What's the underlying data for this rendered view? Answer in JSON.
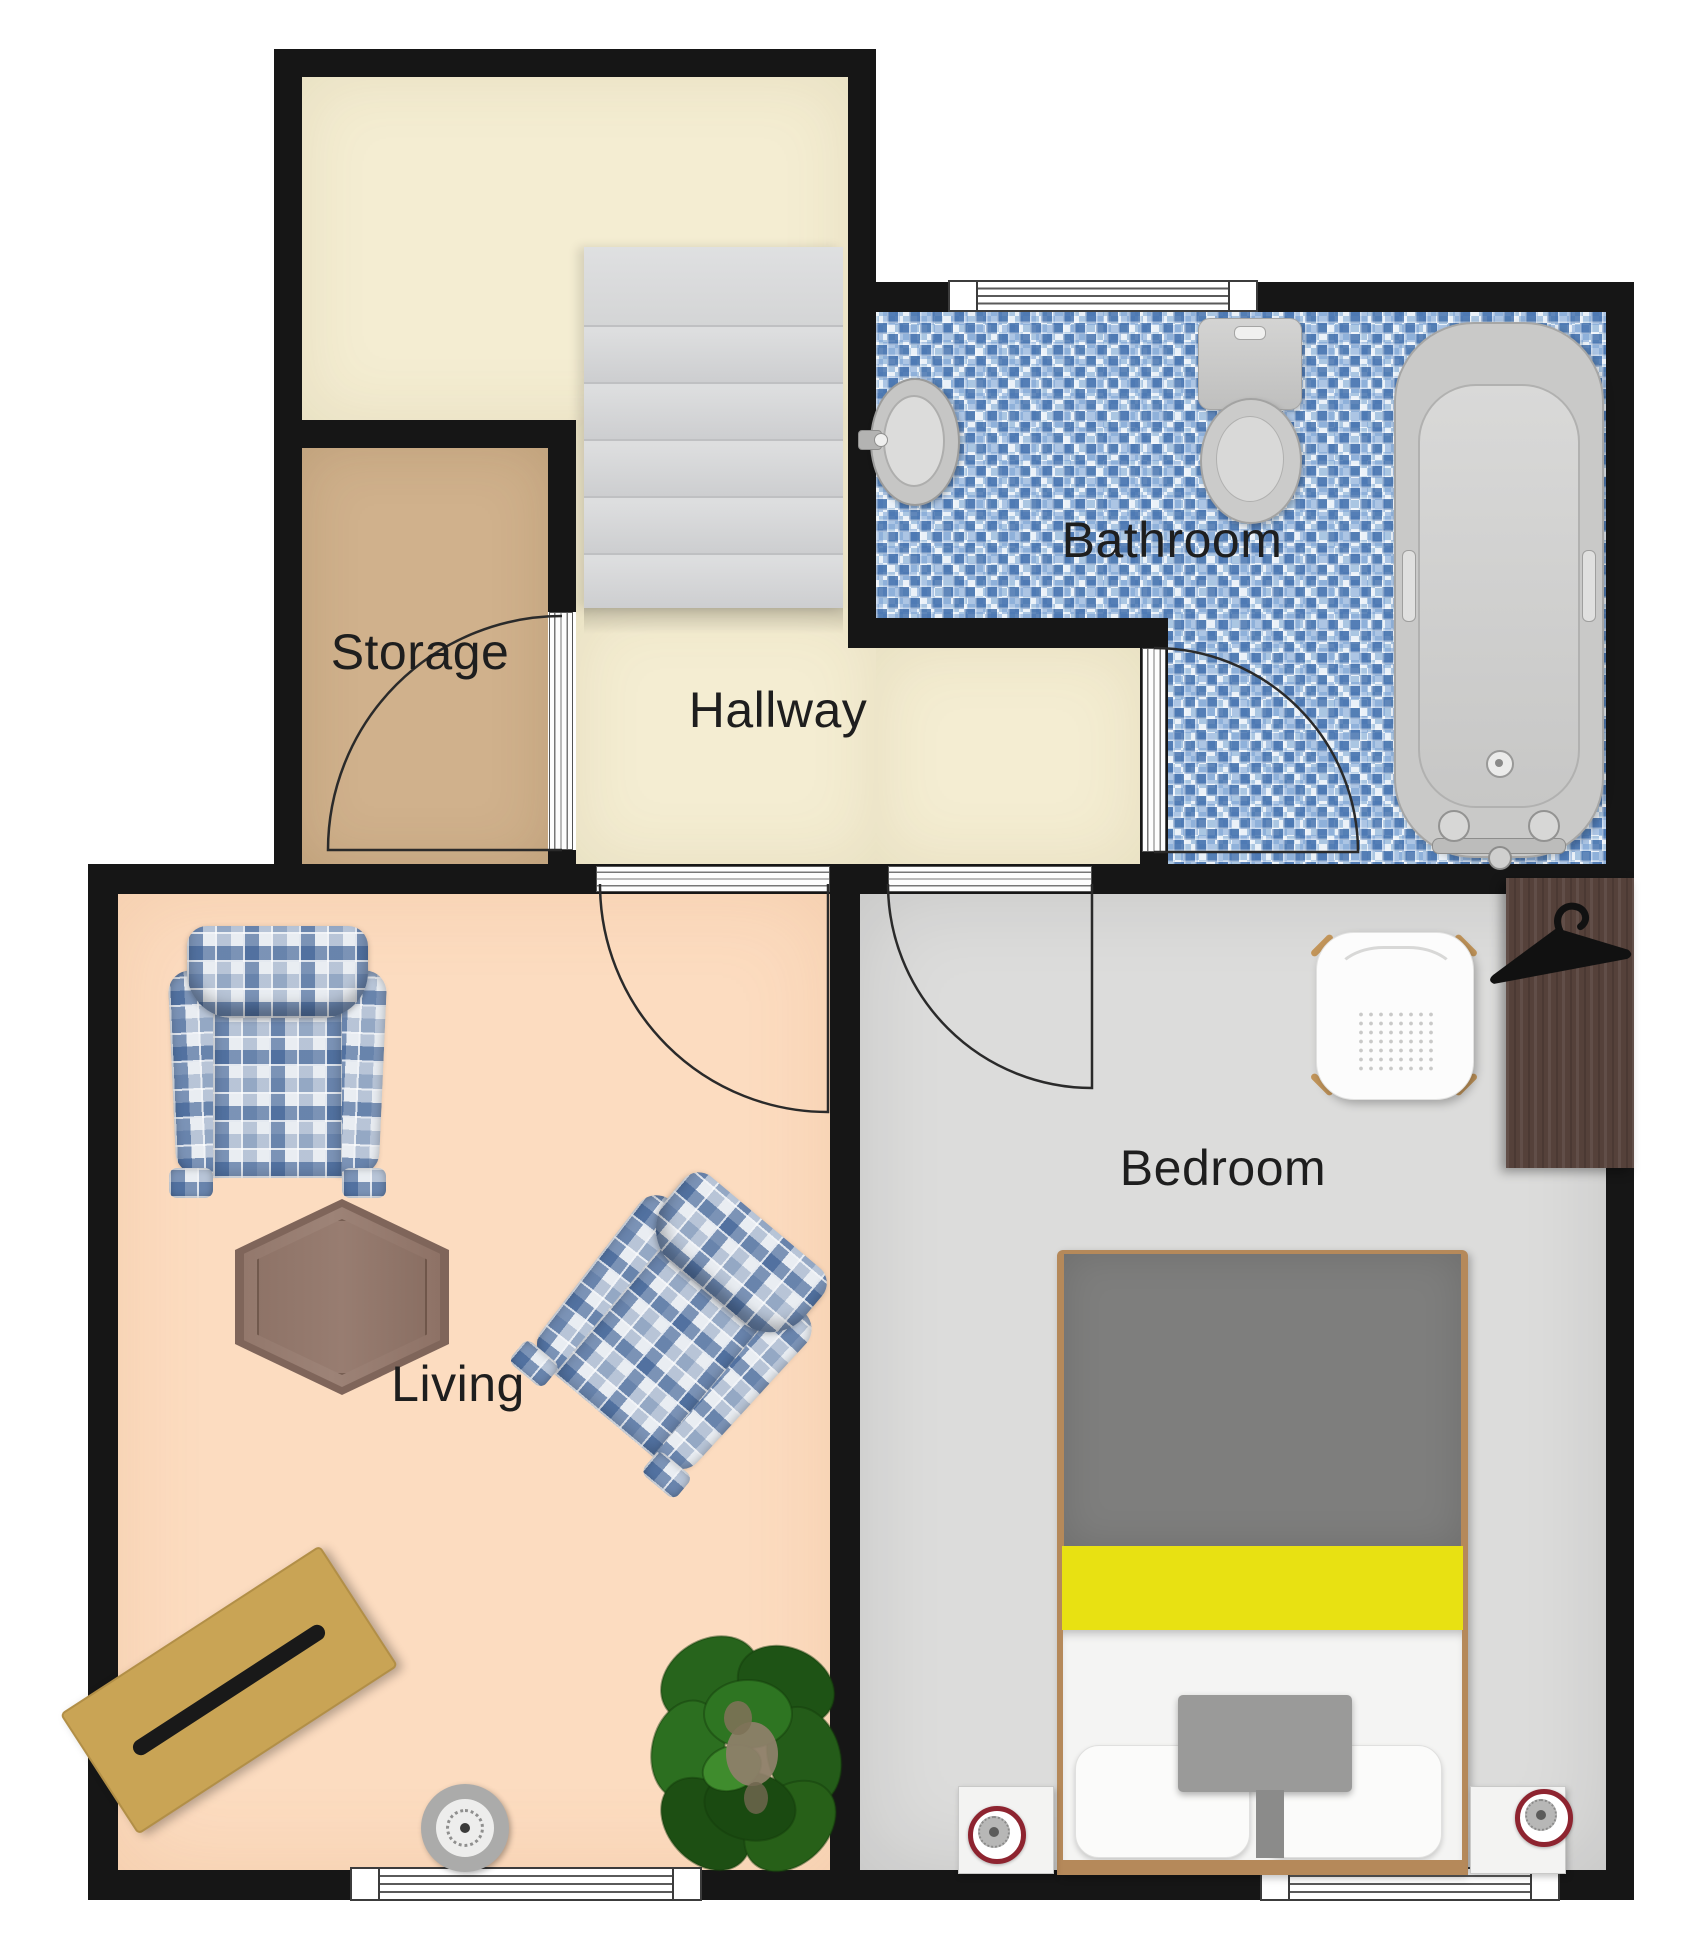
{
  "rooms": {
    "storage": {
      "label": "Storage"
    },
    "hallway": {
      "label": "Hallway"
    },
    "bathroom": {
      "label": "Bathroom"
    },
    "living": {
      "label": "Living"
    },
    "bedroom": {
      "label": "Bedroom"
    }
  },
  "palette": {
    "wall": "#161616",
    "cream_floor": "#f4edd2",
    "storage_floor": "#d0b18c",
    "living_floor": "#fcdcc0",
    "bedroom_floor": "#dcdcdb",
    "bathroom_tile_blue": "#5e8cc0",
    "stairs_gray": "#d8d9da",
    "bed_blanket_gray": "#7e7e7d",
    "bed_stripe_yellow": "#e8e112",
    "wood_frame": "#b5895a",
    "bench_wood": "#c9a455",
    "wardrobe_wood": "#55413a",
    "plaid_blue": "#3a5c92",
    "lamp_ring_red": "#8e2430",
    "plant_green": "#27641c"
  },
  "fixtures": [
    "staircase",
    "storage-door",
    "living-door",
    "bedroom-door",
    "bathroom-door",
    "bathroom-window",
    "living-window",
    "bedroom-window",
    "pedestal-sink",
    "toilet",
    "bathtub",
    "plaid-armchair",
    "plaid-armchair-angled",
    "hexagonal-side-table",
    "wood-bench-table",
    "round-speaker",
    "potted-plant",
    "double-bed",
    "nightstand-left",
    "nightstand-right",
    "table-lamp-left",
    "table-lamp-right",
    "shell-chair",
    "wardrobe",
    "coat-hanger"
  ]
}
